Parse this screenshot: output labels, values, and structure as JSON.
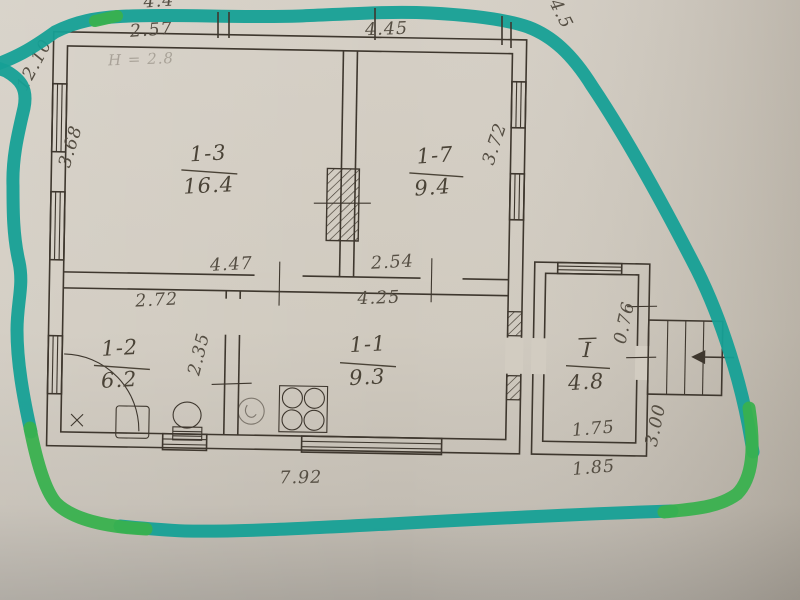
{
  "photo": {
    "subject": "hand-drawn apartment floor plan photo outlined with teal and green highlighter"
  },
  "rooms": [
    {
      "id": "1-3",
      "area": "16.4"
    },
    {
      "id": "1-7",
      "area": "9.4"
    },
    {
      "id": "1-2",
      "area": "6.2"
    },
    {
      "id": "1-1",
      "area": "9.3"
    },
    {
      "id": "I",
      "area": "4.8"
    }
  ],
  "dimensions": {
    "left_total": "12.10",
    "top_partial": "4.4",
    "top_left": "2.57",
    "top_middle": "4.45",
    "top_right_partial": "4.5",
    "height_note": "Н = 2.8",
    "room13_left": "3.68",
    "room17_right": "3.72",
    "mid_left": "4.47",
    "mid_right": "2.54",
    "room11_top": "4.25",
    "room12_top": "2.72",
    "room12_side": "2.35",
    "vestibule_side": "0.76",
    "vestibule_bottom": "1.75",
    "porch_side": "3.00",
    "porch_bottom": "1.85",
    "bottom_total": "7.92"
  },
  "colors": {
    "marker_teal": "#16a096",
    "marker_green": "#39b14e",
    "ink": "#3e372e",
    "pencil": "#554e43",
    "paper": "#d0cabf"
  }
}
